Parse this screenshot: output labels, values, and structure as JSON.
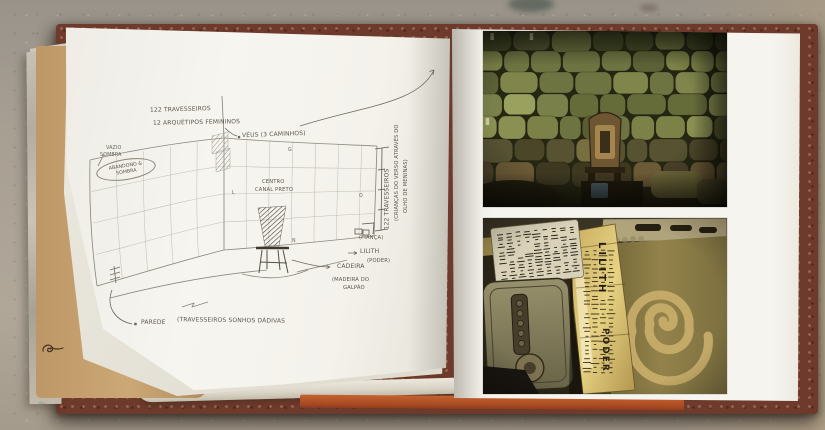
{
  "colors": {
    "concrete": "#a79e92",
    "page_white": "#f6f4ef",
    "kraft_paper": "#c9a26f",
    "cover_maroon": "#6e3a2b",
    "endpaper_orange": "#b05228",
    "pencil": "#5d574d",
    "pillow_olive": "#6e7342",
    "photo_gold": "#c9ad5f"
  },
  "sketch": {
    "annotations": {
      "travesseiros_top": "122 TRAVESSEIROS",
      "arquetipos": "12 ARQUÉTIPOS FEMININOS",
      "veus": "VÉUS (3 CAMINHOS)",
      "vazio": "VAZIO",
      "sombra": "SOMBRA",
      "abandono_1": "ABANDONO &",
      "abandono_2": "SOMBRA",
      "centro_1": "CENTRO",
      "centro_2": "CANAL PRETO",
      "travesseiros_side": "122 TRAVESSEIROS",
      "criancas_1": "(CRIANÇAS DO VERSO ATRAVÉS DO",
      "criancas_2": "OLHO DE MENINAS)",
      "fianca": "(FIANÇA)",
      "lilith": "LILITH",
      "poder": "(PODER)",
      "cadeira": "CADEIRA",
      "madeira_1": "(MADEIRA DO",
      "madeira_2": "GALPÃO",
      "parede": "PAREDE",
      "parede_sub": "(TRAVESSEIROS SONHOS DÁDIVAS",
      "letter_l": "L",
      "letter_g": "G",
      "letter_o": "O",
      "letter_n": "N"
    }
  },
  "photos": {
    "golden_papers": {
      "lilith": "LILITH",
      "poder": "PODER"
    }
  }
}
